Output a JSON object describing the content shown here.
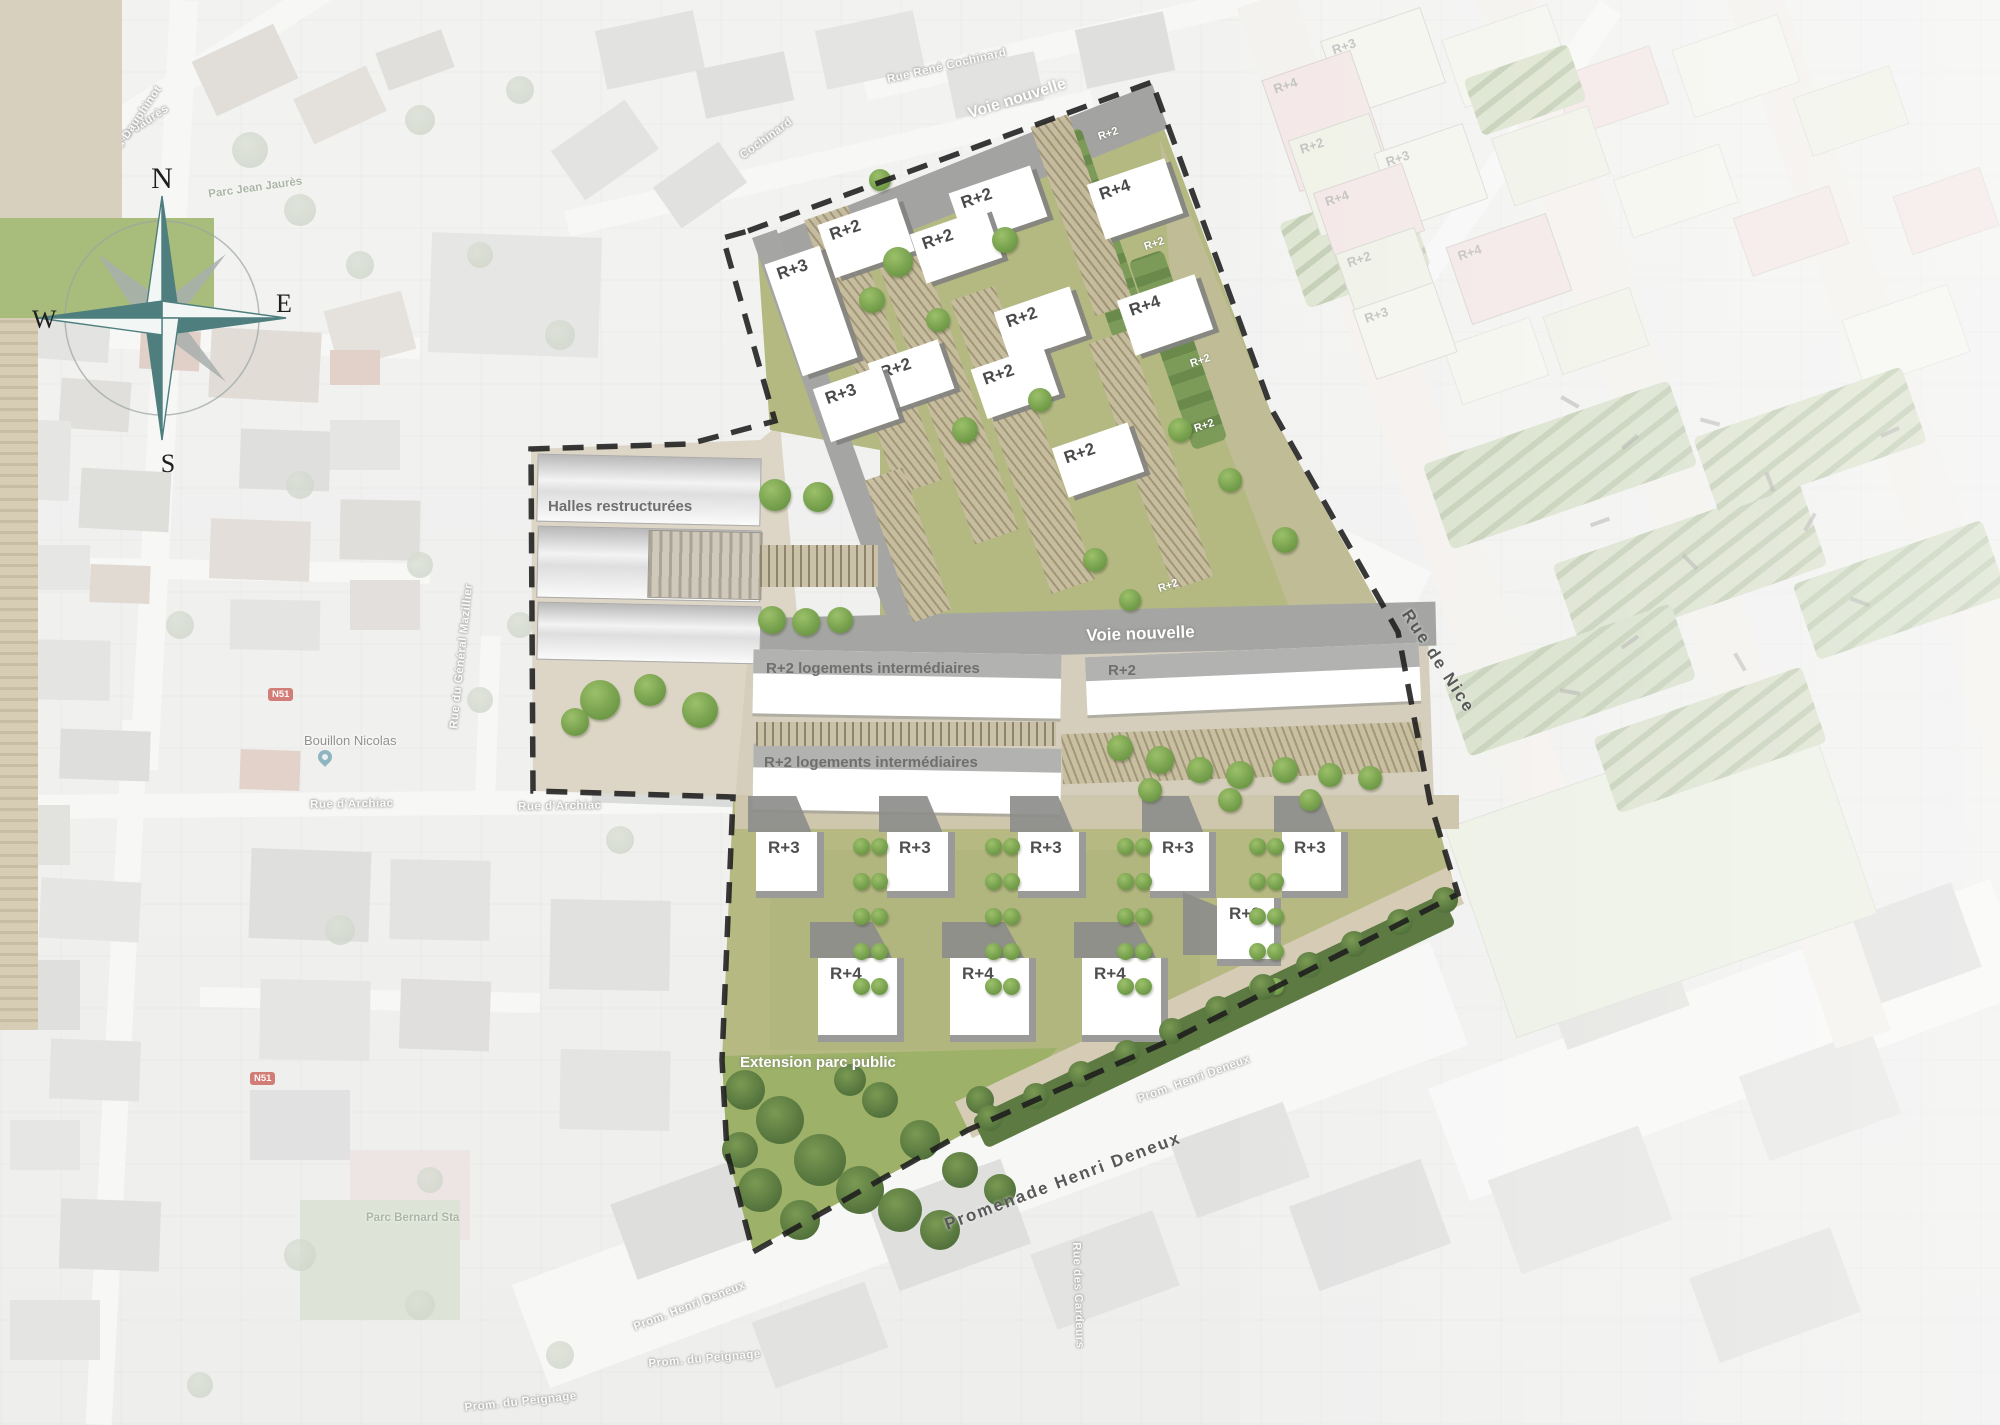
{
  "compass": {
    "north": "N",
    "east": "E",
    "south": "S",
    "west": "W"
  },
  "palette": {
    "accent_teal": "#4e7f7e",
    "site_green": "#b4b982",
    "park_green": "#9db268",
    "road_gray": "#a5a5a3",
    "boundary": "#1c1c1c",
    "pastel_pink": "#e8d4d2",
    "pastel_cream": "#edece2",
    "pastel_green": "#e3e7d4"
  },
  "site": {
    "street_labels": [
      {
        "text": "Voie nouvelle",
        "x": 966,
        "y": 106,
        "rot": -17.5,
        "size": 16
      },
      {
        "text": "Voie nouvelle",
        "x": 1086,
        "y": 626,
        "rot": -2,
        "size": 17
      },
      {
        "text": "Extension parc public",
        "x": 740,
        "y": 1054,
        "rot": 0,
        "size": 15
      }
    ],
    "dark_street_labels": [
      {
        "text": "Rue  de  Nice",
        "x": 1414,
        "y": 606,
        "rot": 57,
        "size": 17
      },
      {
        "text": "Promenade  Henri  Deneux",
        "x": 942,
        "y": 1216,
        "rot": -20.5,
        "size": 17
      }
    ],
    "area_labels": [
      {
        "text": "Halles restructurées",
        "x": 548,
        "y": 498
      },
      {
        "text": "R+2 logements intermédiaires",
        "x": 766,
        "y": 660
      },
      {
        "text": "R+2",
        "x": 1108,
        "y": 662
      },
      {
        "text": "R+2 logements intermédiaires",
        "x": 764,
        "y": 754
      }
    ],
    "upper_buildings": [
      {
        "label": "R+3",
        "x": 782,
        "y": 252,
        "w": 58,
        "h": 118
      },
      {
        "label": "R+2",
        "x": 824,
        "y": 210,
        "w": 84,
        "h": 56
      },
      {
        "label": "R+2",
        "x": 955,
        "y": 178,
        "w": 86,
        "h": 54
      },
      {
        "label": "R+2",
        "x": 916,
        "y": 220,
        "w": 80,
        "h": 52
      },
      {
        "label": "R+2",
        "x": 1000,
        "y": 298,
        "w": 80,
        "h": 52
      },
      {
        "label": "R+2",
        "x": 874,
        "y": 350,
        "w": 74,
        "h": 52
      },
      {
        "label": "R+3",
        "x": 820,
        "y": 376,
        "w": 72,
        "h": 56
      },
      {
        "label": "R+2",
        "x": 977,
        "y": 356,
        "w": 76,
        "h": 52
      },
      {
        "label": "R+4",
        "x": 1094,
        "y": 170,
        "w": 82,
        "h": 58
      },
      {
        "label": "R+4",
        "x": 1124,
        "y": 286,
        "w": 82,
        "h": 58
      },
      {
        "label": "R+2",
        "x": 1058,
        "y": 434,
        "w": 80,
        "h": 52
      }
    ],
    "hedge_labels": [
      {
        "label": "R+2",
        "x": 1098,
        "y": 128
      },
      {
        "label": "R+2",
        "x": 1144,
        "y": 238
      },
      {
        "label": "R+2",
        "x": 1190,
        "y": 355
      },
      {
        "label": "R+2",
        "x": 1194,
        "y": 420
      },
      {
        "label": "R+2",
        "x": 1158,
        "y": 580
      }
    ],
    "lower_r3": [
      {
        "label": "R+3",
        "x": 756,
        "y": 832,
        "w": 68,
        "h": 66
      },
      {
        "label": "R+3",
        "x": 887,
        "y": 832,
        "w": 68,
        "h": 66
      },
      {
        "label": "R+3",
        "x": 1018,
        "y": 832,
        "w": 68,
        "h": 66
      },
      {
        "label": "R+3",
        "x": 1150,
        "y": 832,
        "w": 66,
        "h": 66
      },
      {
        "label": "R+3",
        "x": 1282,
        "y": 832,
        "w": 66,
        "h": 66
      },
      {
        "label": "R+3",
        "x": 1217,
        "y": 898,
        "w": 64,
        "h": 68,
        "left_wedge": true
      }
    ],
    "lower_r4": [
      {
        "label": "R+4",
        "x": 818,
        "y": 958,
        "w": 86,
        "h": 84
      },
      {
        "label": "R+4",
        "x": 950,
        "y": 958,
        "w": 86,
        "h": 84
      },
      {
        "label": "R+4",
        "x": 1082,
        "y": 958,
        "w": 86,
        "h": 84
      }
    ]
  },
  "adjacent": {
    "blocks": [
      {
        "label": "R+3",
        "x": 1330,
        "y": 22,
        "w": 104,
        "h": 78,
        "color": "#edece2"
      },
      {
        "label": "R+4",
        "x": 1278,
        "y": 62,
        "w": 92,
        "h": 116,
        "color": "#e8d4d2"
      },
      {
        "label": "R+2",
        "x": 1302,
        "y": 124,
        "w": 84,
        "h": 100,
        "color": "#e3e7d4"
      },
      {
        "label": "R+3",
        "x": 1384,
        "y": 136,
        "w": 92,
        "h": 78,
        "color": "#edece2"
      },
      {
        "label": "R+4",
        "x": 1322,
        "y": 176,
        "w": 92,
        "h": 70,
        "color": "#e8d4d2"
      },
      {
        "label": "R+2",
        "x": 1348,
        "y": 238,
        "w": 82,
        "h": 92,
        "color": "#e3e7d4"
      },
      {
        "label": "R+4",
        "x": 1456,
        "y": 228,
        "w": 104,
        "h": 80,
        "color": "#e8d4d2"
      },
      {
        "label": "R+3",
        "x": 1362,
        "y": 294,
        "w": 84,
        "h": 72,
        "color": "#edece2"
      }
    ]
  },
  "basemap": {
    "road_labels": [
      {
        "text": "Avenue Jean Jaurès",
        "x": 64,
        "y": 168,
        "rot": -33
      },
      {
        "text": "Boulevard Dauphinot",
        "x": 84,
        "y": 188,
        "rot": -56
      },
      {
        "text": "Brasseurs",
        "x": 22,
        "y": 240,
        "rot": -5
      },
      {
        "text": "Rue René Cochinard",
        "x": 886,
        "y": 74,
        "rot": -13
      },
      {
        "text": "Cochinard",
        "x": 738,
        "y": 152,
        "rot": -36
      },
      {
        "text": "Rue d'Archiac",
        "x": 310,
        "y": 799,
        "rot": -1
      },
      {
        "text": "Rue d'Archiac",
        "x": 518,
        "y": 801,
        "rot": -1
      },
      {
        "text": "Rue du Général Mazillier",
        "x": 448,
        "y": 728,
        "rot": -84
      },
      {
        "text": "Rue des Cardeurs",
        "x": 1082,
        "y": 1242,
        "rot": 88
      },
      {
        "text": "Prom. Henri Deneux",
        "x": 1136,
        "y": 1094,
        "rot": -20
      },
      {
        "text": "Prom. Henri Deneux",
        "x": 632,
        "y": 1322,
        "rot": -21
      },
      {
        "text": "Prom. du Peignage",
        "x": 648,
        "y": 1358,
        "rot": -5
      },
      {
        "text": "Prom. du Peignage",
        "x": 464,
        "y": 1402,
        "rot": -6
      }
    ],
    "park_labels": [
      {
        "text": "Parc Jean Jaurès",
        "x": 208,
        "y": 182,
        "rot": -8
      },
      {
        "text": "Parc Bernard Sta",
        "x": 366,
        "y": 1212,
        "rot": 0
      }
    ],
    "poi_labels": [
      {
        "text": "Bouillon Nicolas",
        "x": 304,
        "y": 733
      }
    ],
    "shields": [
      {
        "text": "N51",
        "x": 268,
        "y": 688
      },
      {
        "text": "N51",
        "x": 250,
        "y": 1072
      }
    ]
  }
}
